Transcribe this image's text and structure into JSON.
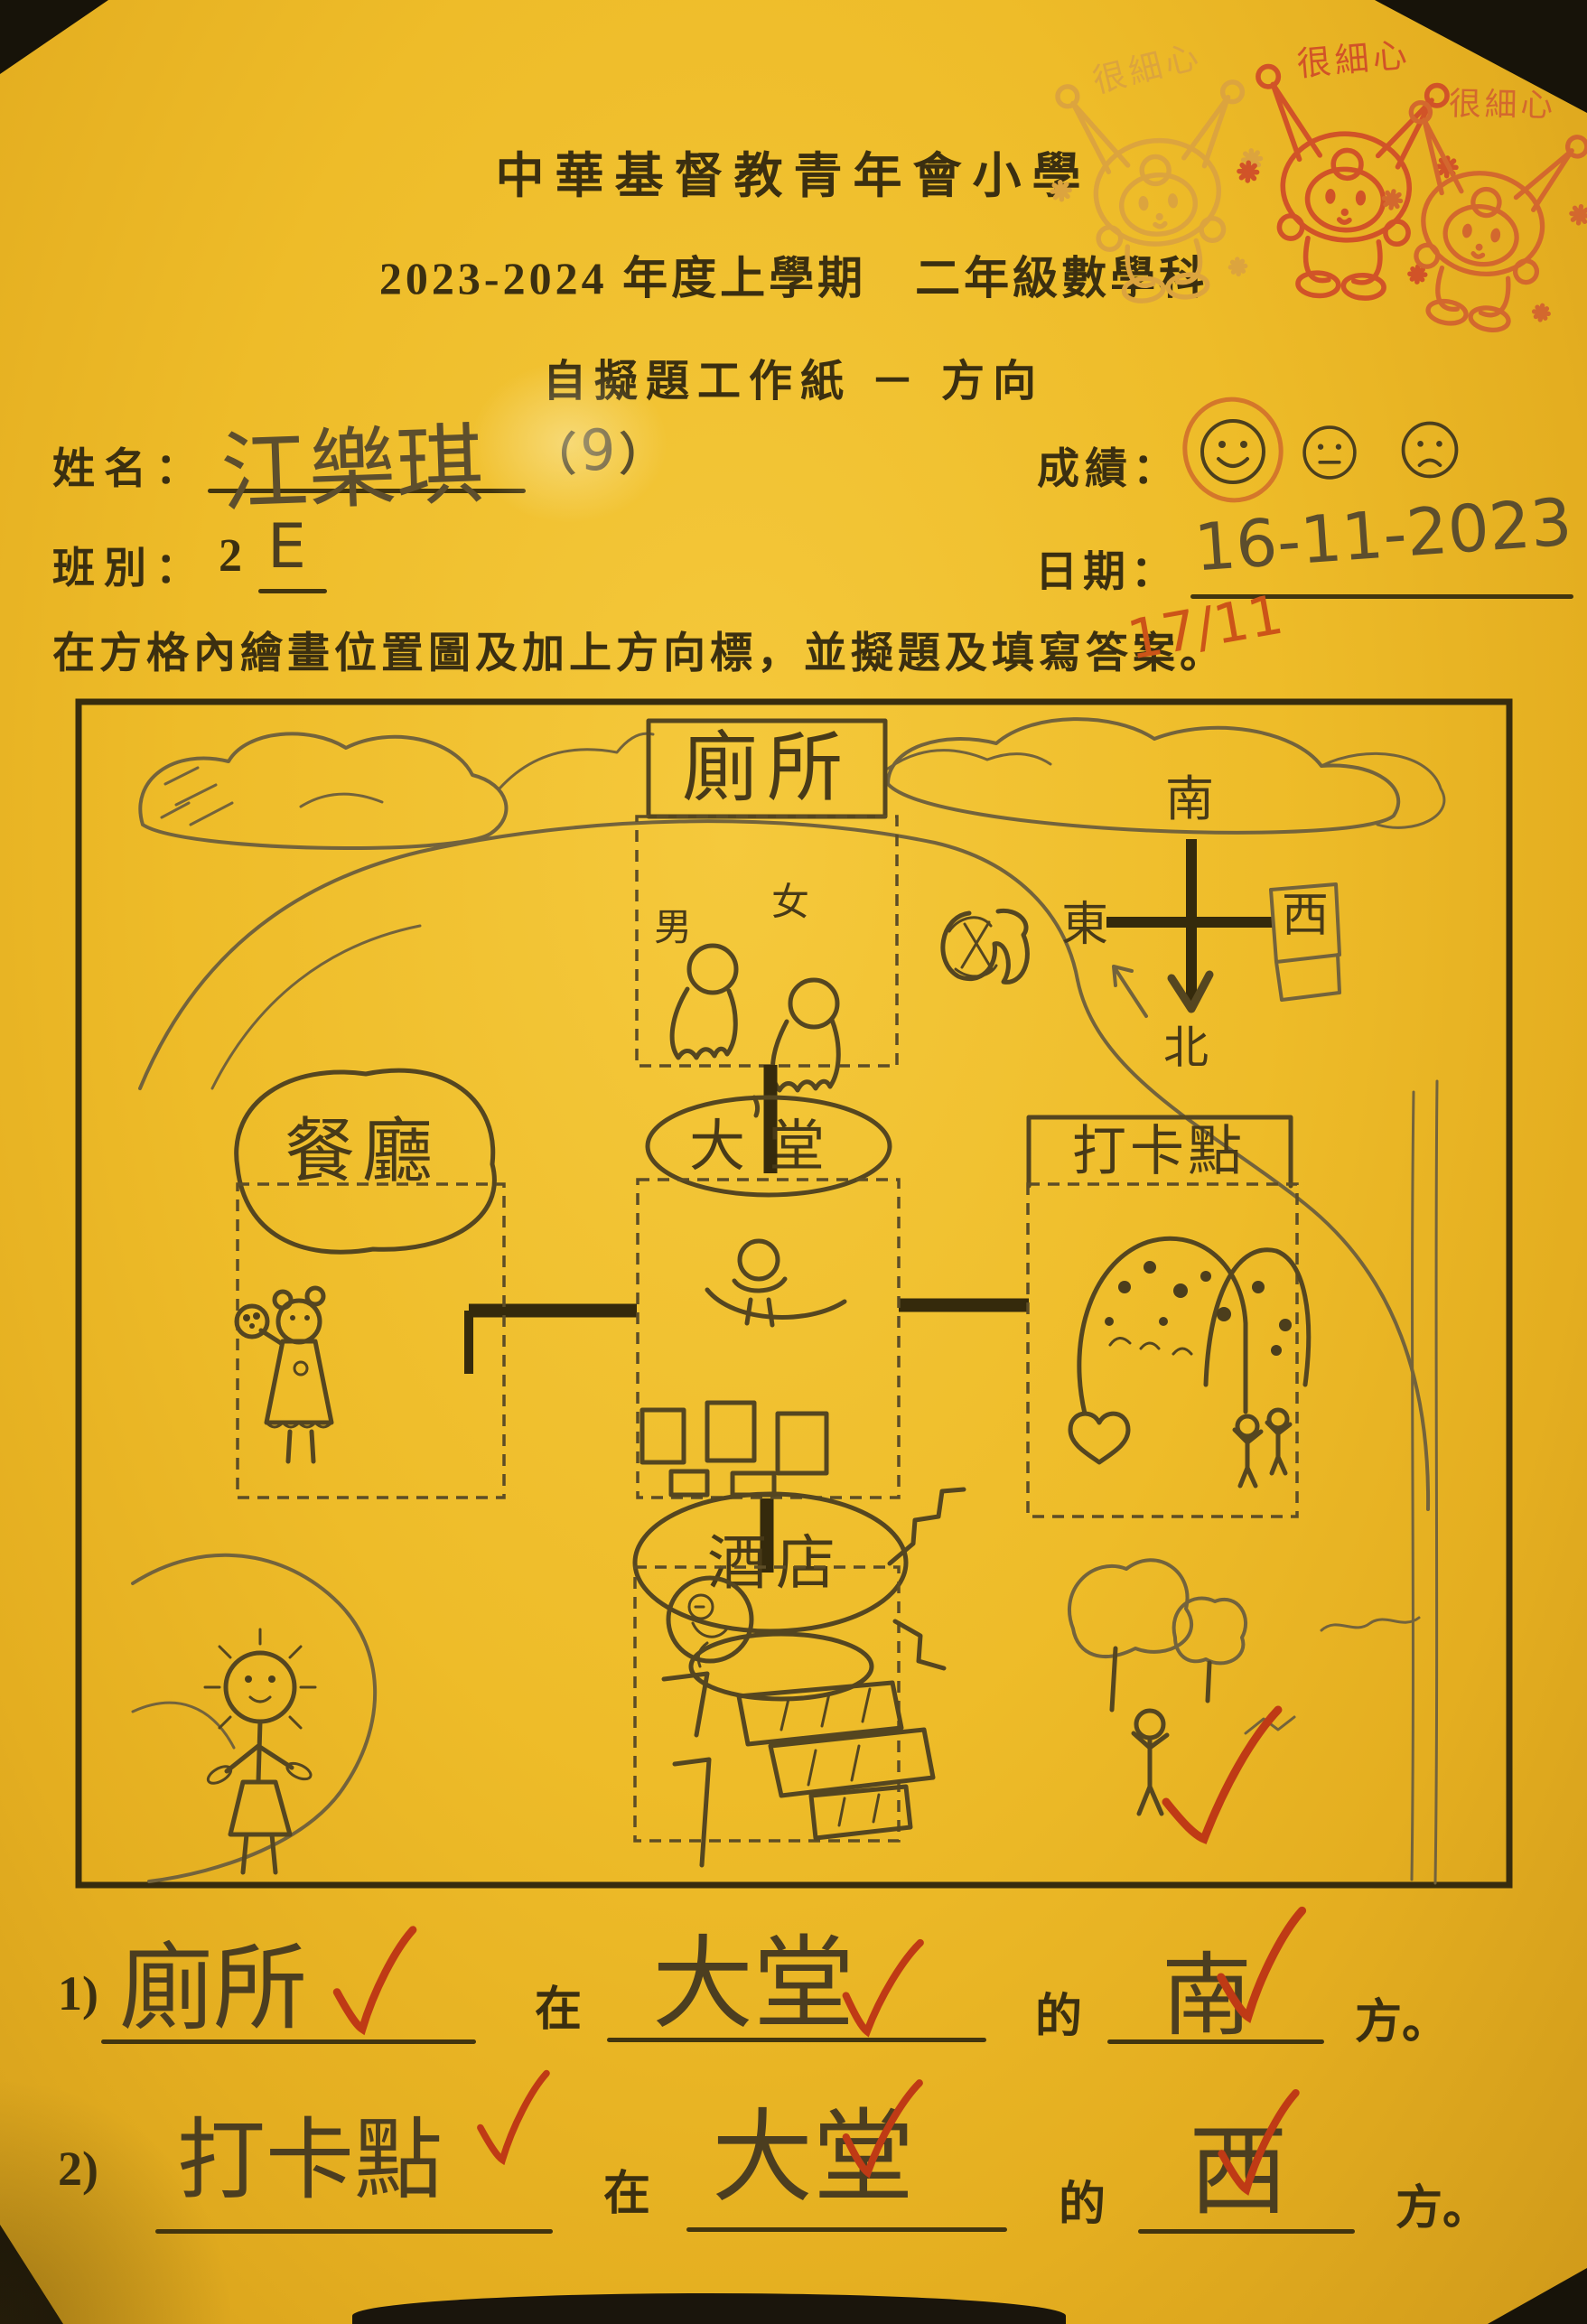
{
  "header": {
    "school": "中華基督教青年會小學",
    "term": "2023-2024 年度上學期　二年級數學科",
    "title": "自擬題工作紙 － 方向"
  },
  "stamps": {
    "text": "很細心",
    "count": 3
  },
  "fields": {
    "name_label": "姓名：",
    "name_value": "江樂琪",
    "name_paren_open": "（",
    "name_number": "9",
    "name_paren_close": "）",
    "score_label": "成績：",
    "score_selected": "happy",
    "class_label": "班別：",
    "class_prefix": "2",
    "class_value": "E",
    "date_label": "日期：",
    "date_value": "16-11-2023"
  },
  "instruction": "在方格內繪畫位置圖及加上方向標，並擬題及填寫答案。",
  "teacher_note": "17/11",
  "map": {
    "locations": {
      "toilet": "廁所",
      "lobby": "大堂",
      "restaurant": "餐廳",
      "checkin": "打卡點",
      "hotel": "酒店"
    },
    "toilet_signs": {
      "male": "男",
      "female": "女"
    },
    "compass": {
      "top": "南",
      "left": "東",
      "right": "西",
      "bottom": "北"
    }
  },
  "questions": [
    {
      "no": "1)",
      "subject": "廁所",
      "in": "在",
      "reference": "大堂",
      "of": "的",
      "direction": "南",
      "suffix": "方。"
    },
    {
      "no": "2)",
      "subject": "打卡點",
      "in": "在",
      "reference": "大堂",
      "of": "的",
      "direction": "西",
      "suffix": "方。"
    }
  ],
  "colors": {
    "paper": "#eebc29",
    "ink": "#3b2f10",
    "pencil": "#5d4e2d",
    "red_pen": "#bf3a15",
    "stamp_orange": "#d4682e"
  }
}
